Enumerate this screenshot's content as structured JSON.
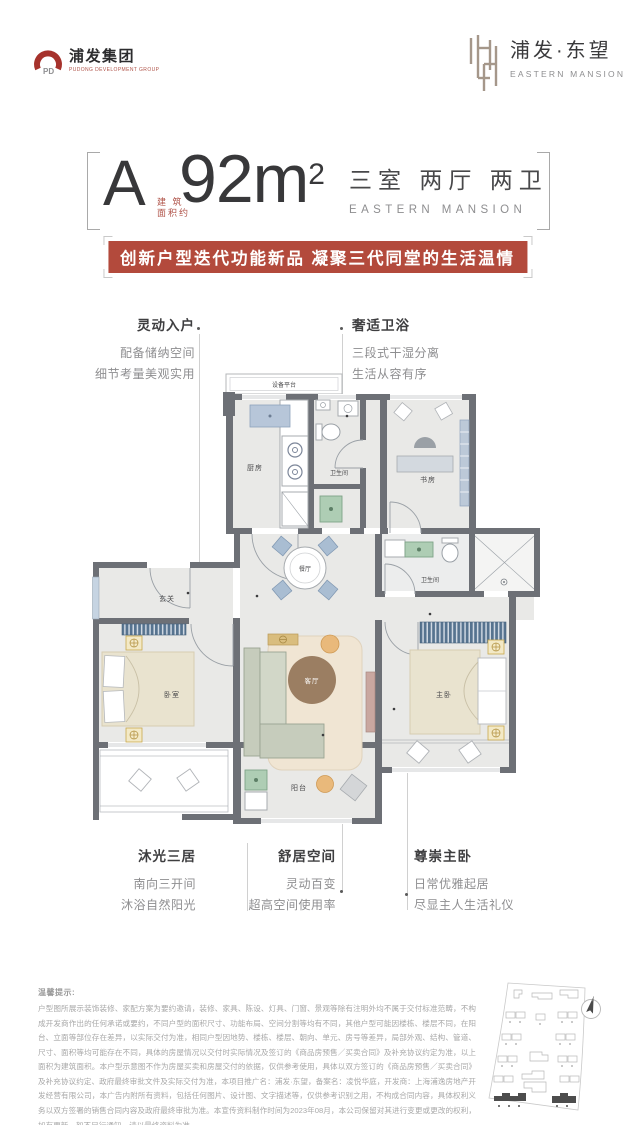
{
  "brand_left": {
    "name": "浦发集团",
    "tagline": "PUDONG DEVELOPMENT GROUP",
    "monogram": "PD"
  },
  "brand_right": {
    "name": "浦发·东望",
    "tagline": "EASTERN MANSION"
  },
  "header": {
    "unit": "A",
    "area_note_l1": "建 筑",
    "area_note_l2": "面积约",
    "area_value": "92m",
    "area_sup": "2",
    "rooms": "三室 两厅 两卫",
    "rooms_sub": "EASTERN MANSION",
    "banner": "创新户型迭代功能新品 凝聚三代同堂的生活温情"
  },
  "callouts": {
    "entry": {
      "title": "灵动入户",
      "l1": "配备储纳空间",
      "l2": "细节考量美观实用"
    },
    "bath": {
      "title": "奢适卫浴",
      "l1": "三段式干湿分离",
      "l2": "生活从容有序"
    },
    "bedrooms": {
      "title": "沐光三居",
      "l1": "南向三开间",
      "l2": "沐浴自然阳光"
    },
    "living": {
      "title": "舒居空间",
      "l1": "灵动百变",
      "l2": "超高空间使用率"
    },
    "master": {
      "title": "尊崇主卧",
      "l1": "日常优雅起居",
      "l2": "尽显主人生活礼仪"
    }
  },
  "floorplan": {
    "rooms": {
      "equipment": "设备平台",
      "kitchen": "厨房",
      "bath1": "卫生间",
      "study": "书房",
      "dining": "餐厅",
      "foyer": "玄关",
      "bath2": "卫生间",
      "bedroom": "卧室",
      "living": "客厅",
      "master": "主卧",
      "balcony": "阳台"
    }
  },
  "disclaimer": {
    "title": "温馨提示:",
    "body": "户型图所展示装饰装修、家配方案为要约邀请，装修、家具、陈设、灯具、门窗、景观等除有注明外均不属于交付标准范畴，不构成开发商作出的任何承诺或要约，不同户型的面积尺寸、功能布局、空间分割等均有不同，其他户型可能因楼栋、楼层不同，在阳台、立面等部位存在差异，以实际交付为准，相同户型因地势、楼栋、楼层、朝向、单元、房号等差异，局部外观、结构、管道、尺寸、面积等均可能存在不同，具体的房屋情况以交付时实际情况及签订的《商品房预售／买卖合同》及补充协议约定为准，以上面积为建筑面积。本户型示意图不作为房屋买卖和房屋交付的依据，仅供参考使用，具体以双方签订的《商品房预售／买卖合同》及补充协议约定、政府最终审批文件及实际交付为准，本项目推广名：浦发·东望，备案名：凌悦华庭，开发商：上海浦逸房地产开发经营有限公司，本广告内附所有资料，包括任何图片、设计图、文字描述等，仅供参考识别之用，不构成合同内容，具体权利义务以双方签署的销售合同内容及政府最终审批为准。本宣传资料制作时间为2023年08月，本公司保留对其进行变更或更改的权利，如有更新，恕不另行通知，请以最终资料为准。"
  },
  "colors": {
    "accent_red": "#b34a3c",
    "wall_gray": "#6d7076",
    "brand_gold": "#a5978a"
  }
}
